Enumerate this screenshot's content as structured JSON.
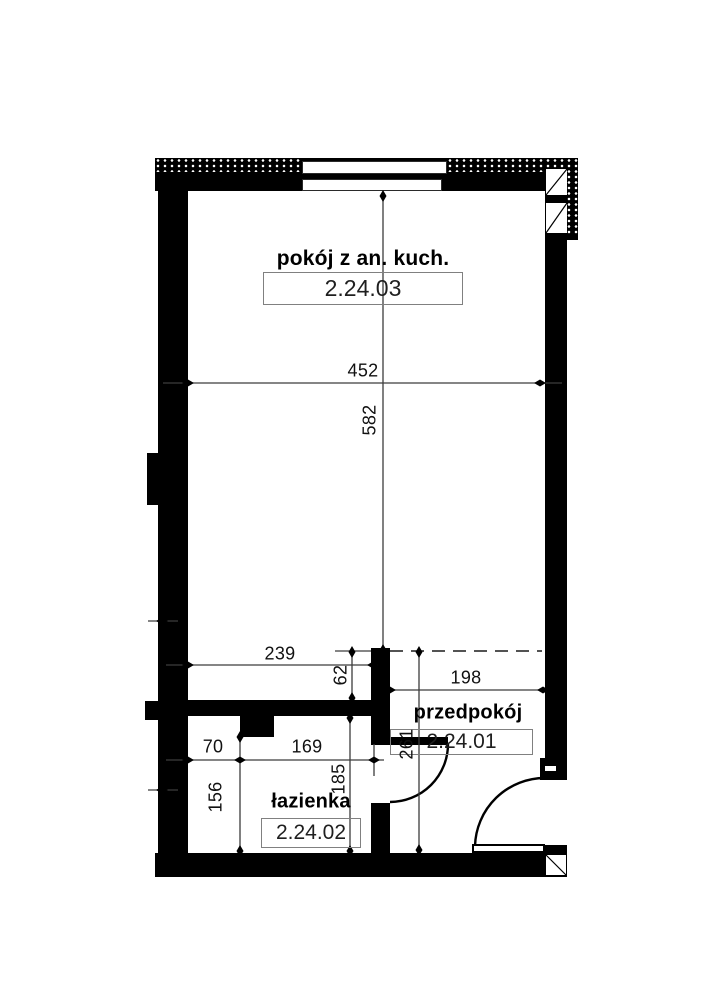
{
  "rooms": {
    "main": {
      "name": "pokój z an. kuch.",
      "number": "2.24.03"
    },
    "hall": {
      "name": "przedpokój",
      "number": "2.24.01"
    },
    "bath": {
      "name": "łazienka",
      "number": "2.24.02"
    }
  },
  "dimensions": {
    "main_width": "452",
    "main_height": "582",
    "left_width": "239",
    "pass_gap": "62",
    "hall_width": "198",
    "hall_height": "261",
    "bath_left": "70",
    "bath_width": "169",
    "bath_height": "185",
    "bath_left_height": "156"
  },
  "colors": {
    "wall": "#000000",
    "dimension_line": "#3c3c3c",
    "room_number_text": "#1f1f1f",
    "box_border": "#808080"
  }
}
